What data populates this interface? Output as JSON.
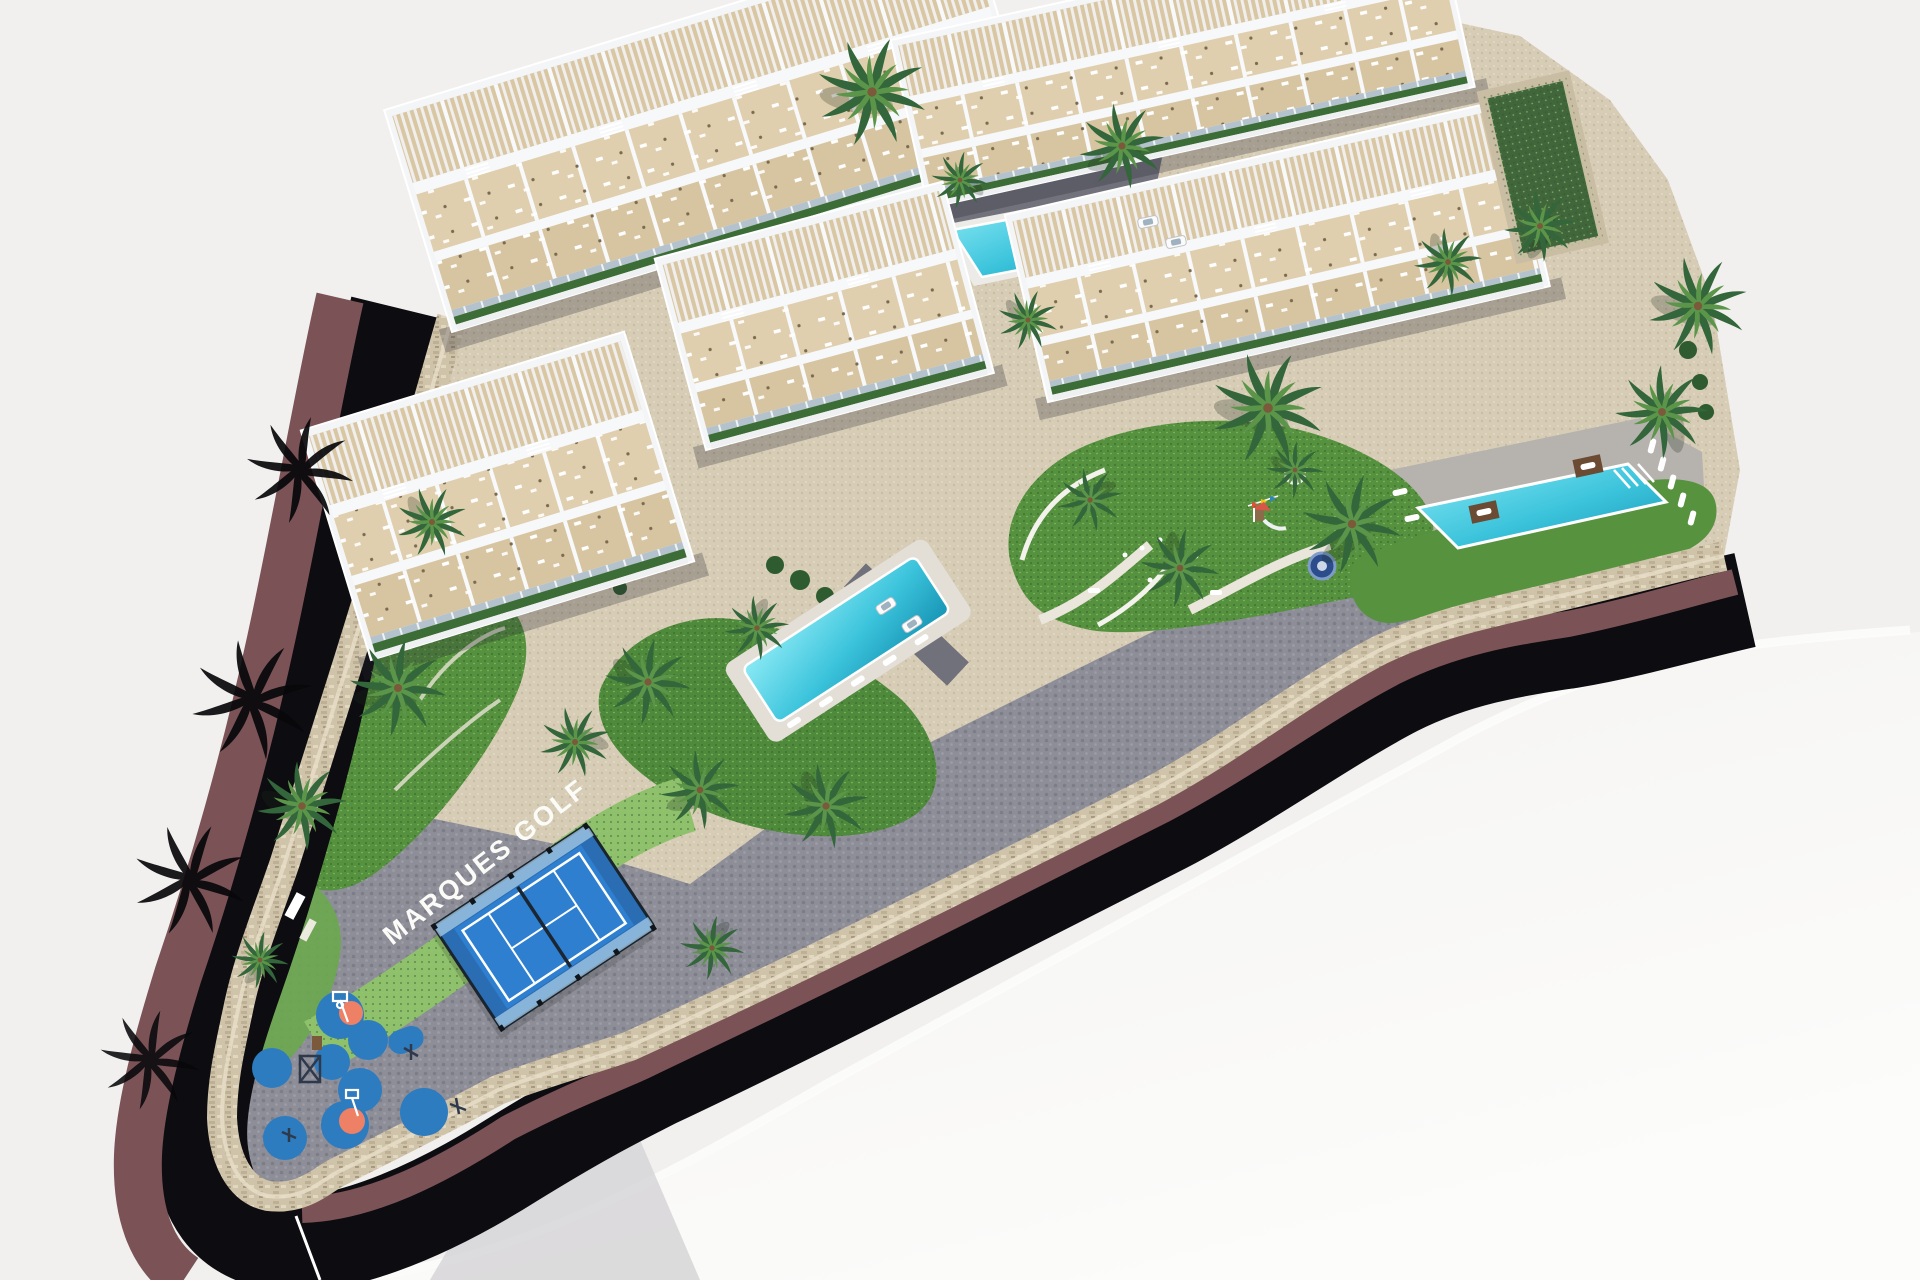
{
  "site": {
    "label": "MARQUES GOLF"
  },
  "inventory": {
    "apartment_blocks": 5,
    "swimming_pools": 3,
    "padel_courts": 1,
    "playgrounds": 2,
    "trampolines": 1,
    "parked_cars": 4,
    "palm_trees": 24
  },
  "palette": {
    "background": "#f1f0ee",
    "background_bottom": "#f7f6f4",
    "road_asphalt": "#0d0c11",
    "sidewalk_maroon": "#7b5356",
    "stone_wall": "#cfc3aa",
    "paving_grey": "#8e8e98",
    "gravel_beige": "#d7cdb7",
    "lawn_green": "#55913e",
    "label_band_green": "#8fc06b",
    "palm_green": "#33663a",
    "pool_water": "#3cc8de",
    "building_white": "#f4f5f7",
    "terrace_beige": "#d9c7a3",
    "glass_blue": "#b3c2cd",
    "padel_blue": "#2e7fd0",
    "playground_blue": "#2d7cc0",
    "playground_accent": "#ee8066"
  }
}
